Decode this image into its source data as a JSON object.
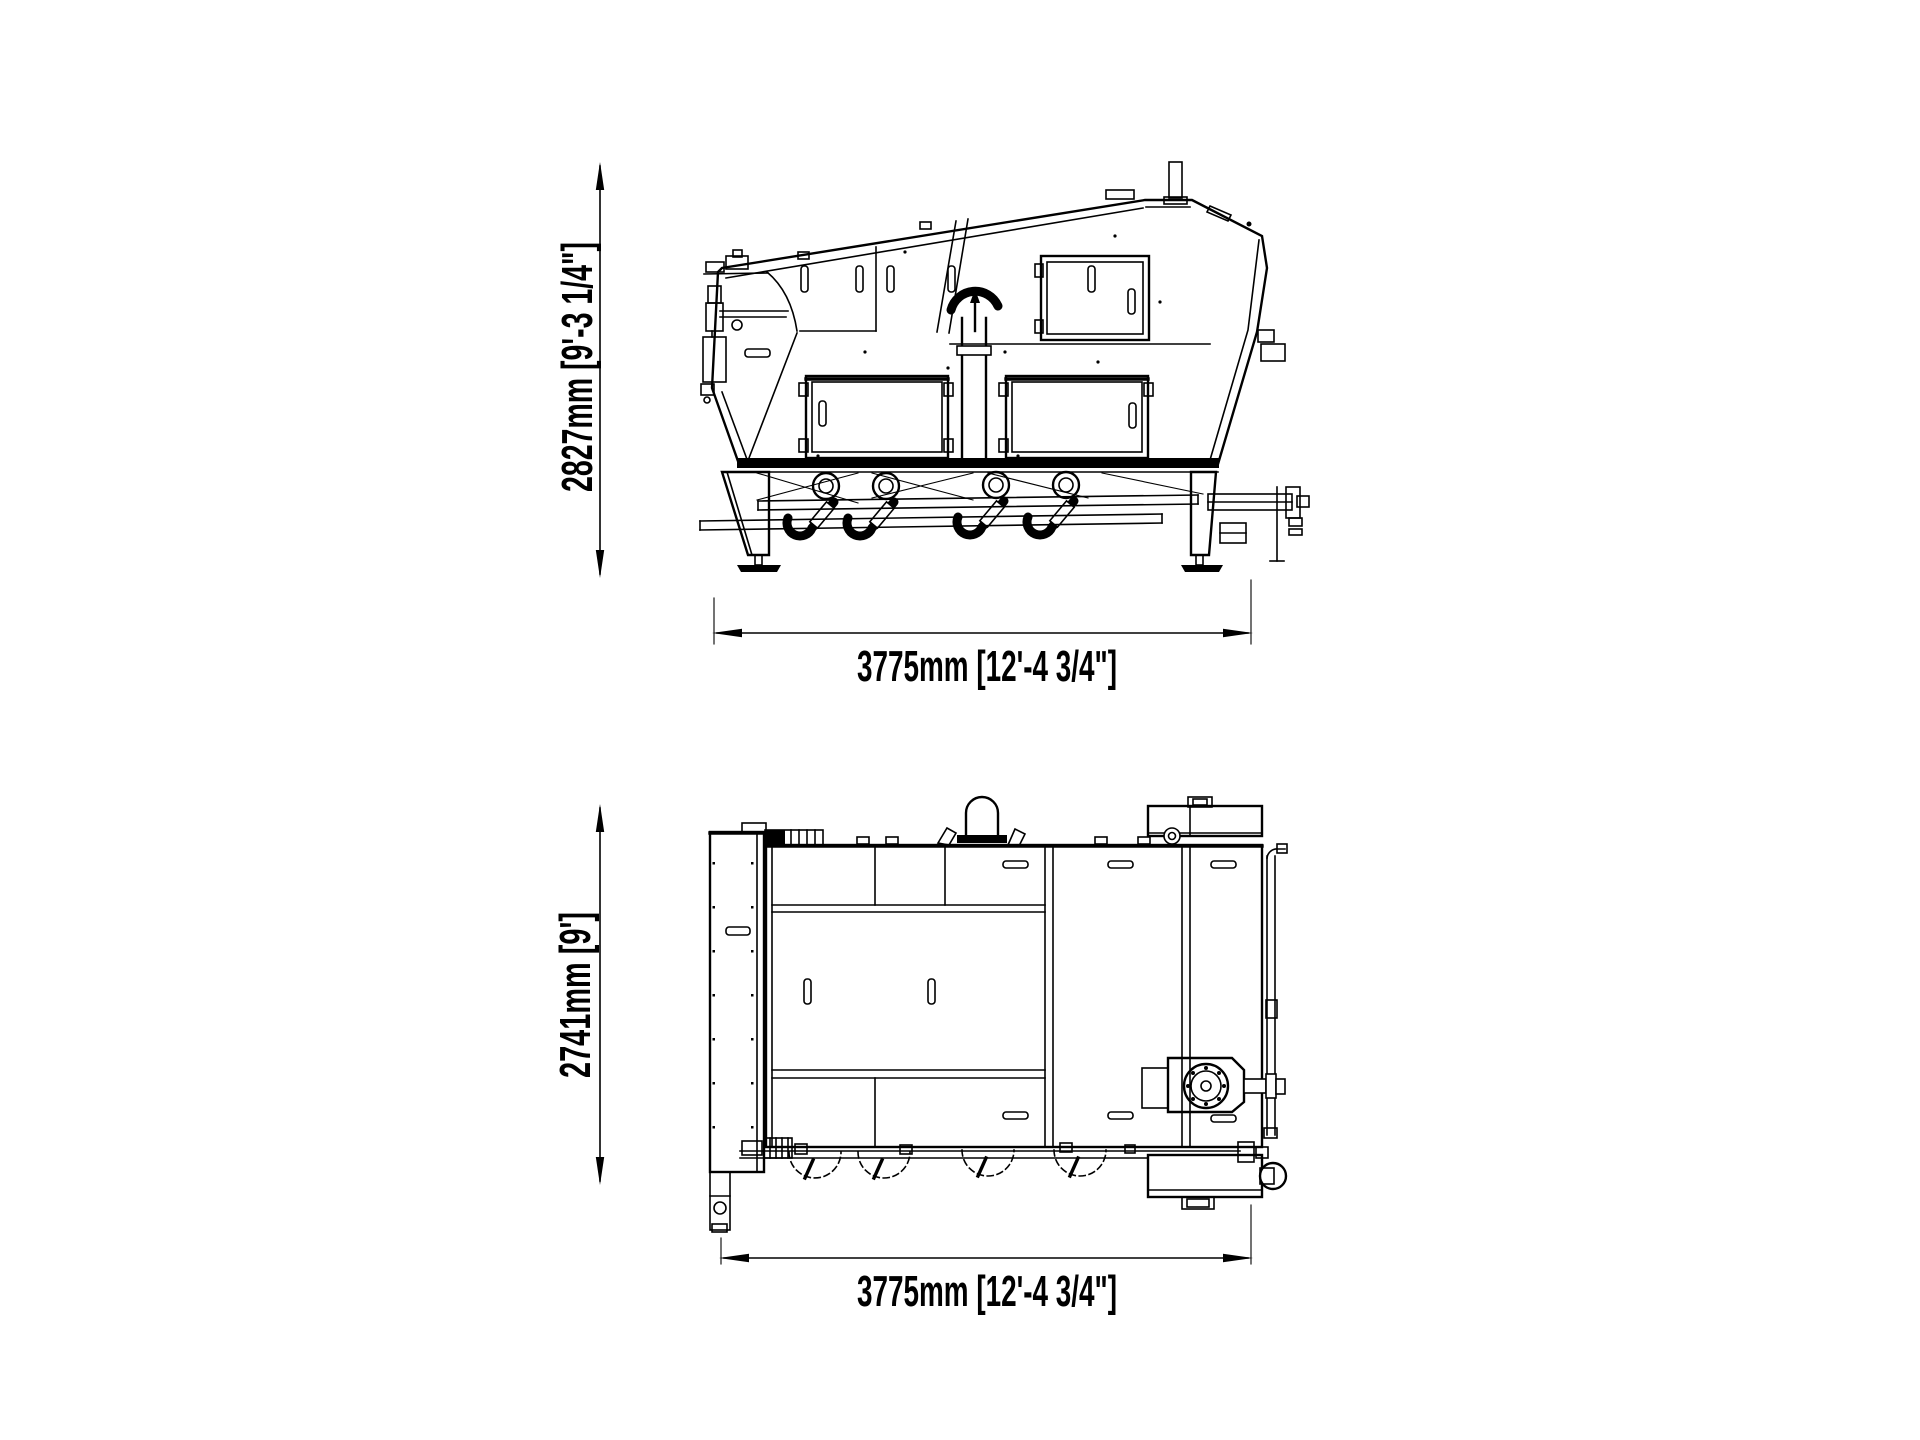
{
  "drawing": {
    "background_color": "#ffffff",
    "line_color": "#000000",
    "side_view": {
      "height_label": "2827mm [9'-3 1/4\"]",
      "length_label": "3775mm [12'-4 3/4\"]"
    },
    "plan_view": {
      "depth_label": "2741mm [9']",
      "length_label": "3775mm [12'-4 3/4\"]"
    }
  }
}
